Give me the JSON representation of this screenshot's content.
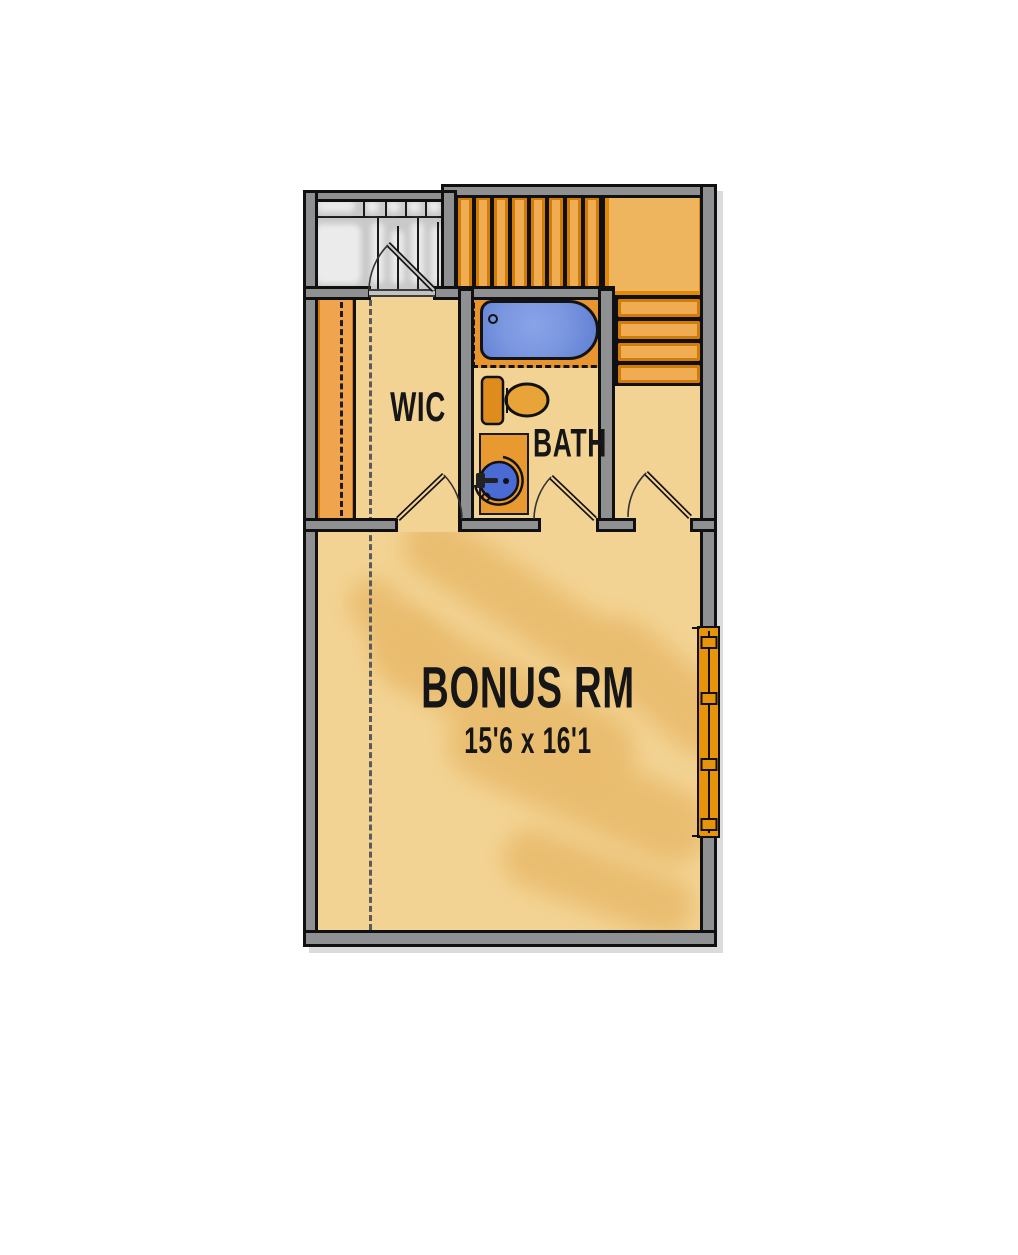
{
  "rooms": {
    "wic": {
      "label": "WIC"
    },
    "bath": {
      "label": "BATH"
    },
    "bonus": {
      "label": "BONUS RM",
      "dimensions": "15'6 x 16'1"
    }
  },
  "colors": {
    "floor": "#F3D393",
    "floor_shade": "#E9BC6E",
    "wall_fill": "#8F9092",
    "outline": "#101010",
    "stair_tread": "#EFAC52",
    "stair_tread_edge": "#D27C05",
    "stair_landing": "#EFB55E",
    "cabinet_orange": "#E8952F",
    "tub_water_blue": "#7B97E0",
    "sink_water_blue": "#4A6AD4",
    "attic_gray": "#C9C9C9",
    "window_frame": "#E8940A",
    "label_text": "#161616"
  }
}
